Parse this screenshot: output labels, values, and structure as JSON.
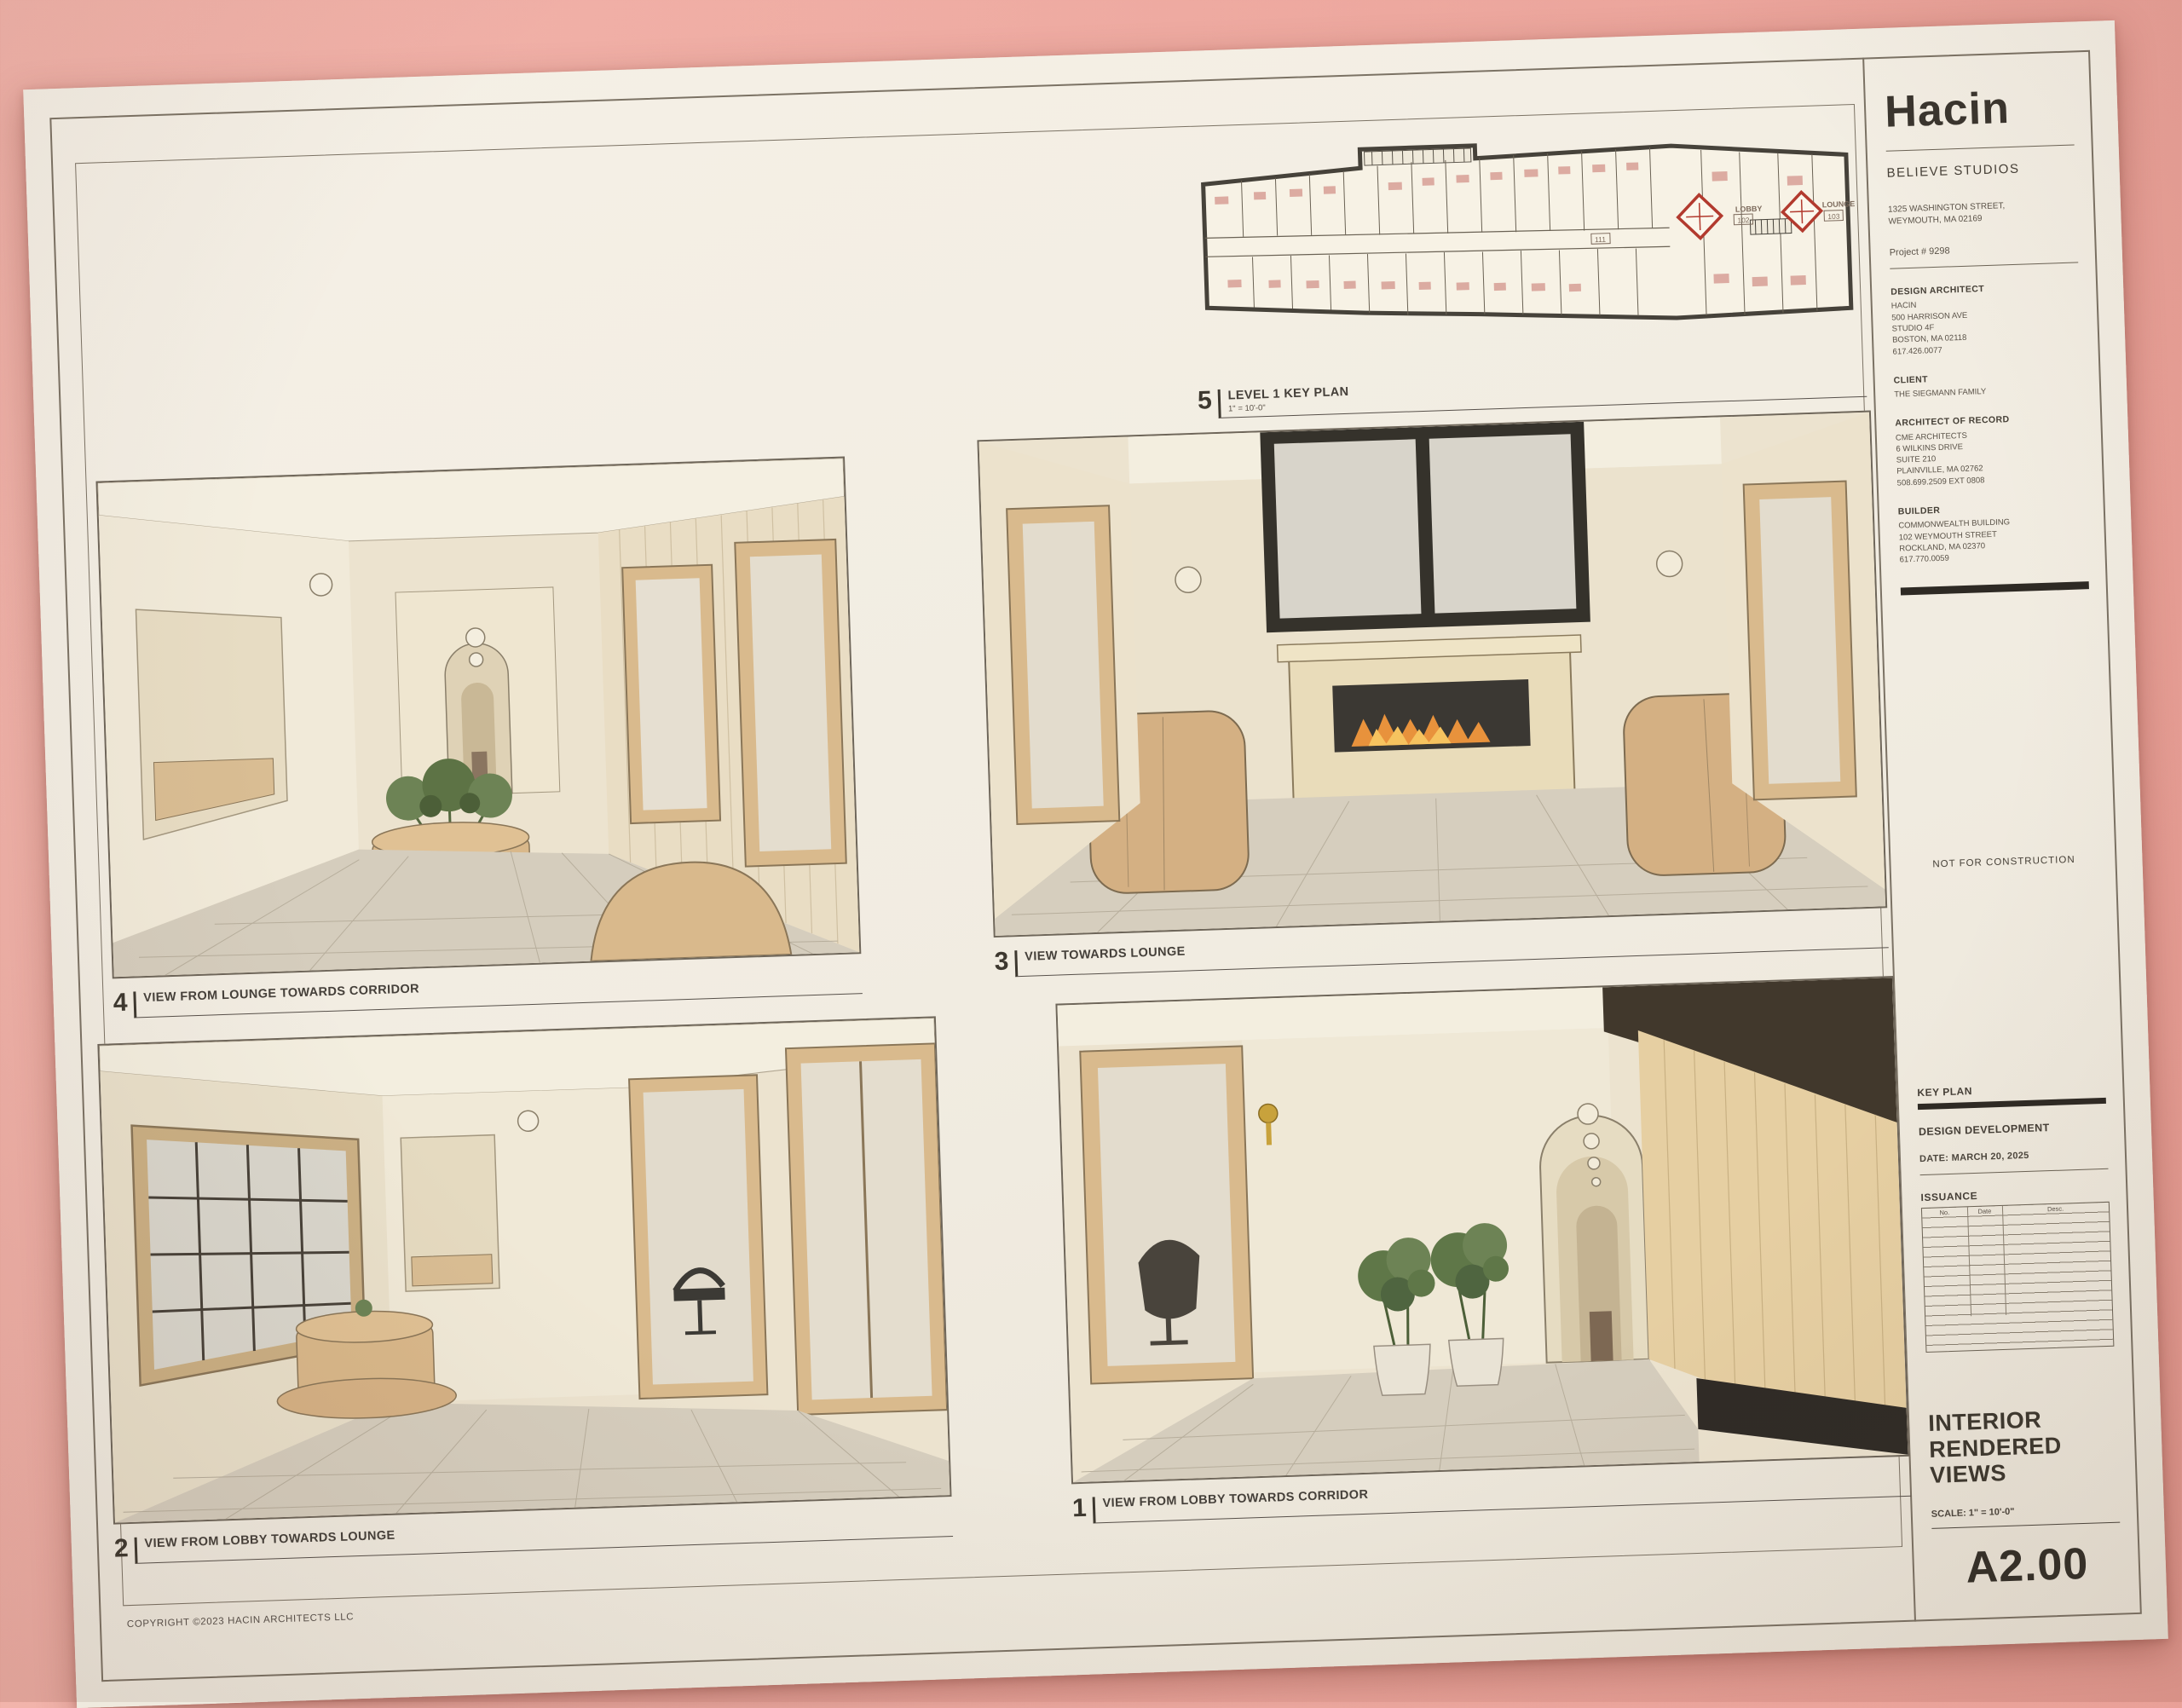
{
  "titleblock": {
    "logo": "Hacin",
    "studio": "BELIEVE STUDIOS",
    "address_line1": "1325 WASHINGTON STREET,",
    "address_line2": "WEYMOUTH, MA 02169",
    "project": "Project #  9298",
    "design_architect": {
      "heading": "DESIGN ARCHITECT",
      "lines": [
        "HACIN",
        "500 HARRISON AVE",
        "STUDIO 4F",
        "BOSTON, MA 02118",
        "617.426.0077"
      ]
    },
    "client": {
      "heading": "CLIENT",
      "lines": [
        "THE SIEGMANN FAMILY"
      ]
    },
    "architect_of_record": {
      "heading": "ARCHITECT OF RECORD",
      "lines": [
        "CME ARCHITECTS",
        "6 WILKINS DRIVE",
        "SUITE 210",
        "PLAINVILLE, MA 02762",
        "508.699.2509 EXT 0808"
      ]
    },
    "builder": {
      "heading": "BUILDER",
      "lines": [
        "COMMONWEALTH BUILDING",
        "102 WEYMOUTH STREET",
        "ROCKLAND, MA 02370",
        "617.770.0059"
      ]
    },
    "not_for_construction": "NOT FOR CONSTRUCTION",
    "key_plan_label": "KEY PLAN",
    "phase": "DESIGN DEVELOPMENT",
    "date": "DATE: MARCH 20, 2025",
    "issuance_label": "ISSUANCE",
    "issuance_columns": [
      "No.",
      "Date",
      "Desc."
    ],
    "sheet_title_line1": "INTERIOR",
    "sheet_title_line2": "RENDERED",
    "sheet_title_line3": "VIEWS",
    "scale": "SCALE:  1\" = 10'-0\"",
    "sheet_number": "A2.00"
  },
  "views": {
    "v5": {
      "number": "5",
      "title": "LEVEL 1 KEY PLAN",
      "scale": "1\" = 10'-0\""
    },
    "v4": {
      "number": "4",
      "title": "VIEW FROM LOUNGE TOWARDS CORRIDOR"
    },
    "v3": {
      "number": "3",
      "title": "VIEW TOWARDS LOUNGE"
    },
    "v2": {
      "number": "2",
      "title": "VIEW FROM LOBBY TOWARDS LOUNGE"
    },
    "v1": {
      "number": "1",
      "title": "VIEW FROM LOBBY TOWARDS CORRIDOR"
    }
  },
  "key_plan": {
    "lobby_label": "LOBBY",
    "lounge_label": "LOUNGE",
    "room_102": "102",
    "room_103": "103",
    "room_111": "111"
  },
  "copyright": "COPYRIGHT  ©2023  HACIN ARCHITECTS LLC",
  "colors": {
    "wall_pink": "#eeaaa1",
    "paper": "#f1ece1",
    "ink": "#453f37",
    "wood_tan": "#d9ba8d",
    "plan_marker_red": "#b23a2e"
  }
}
